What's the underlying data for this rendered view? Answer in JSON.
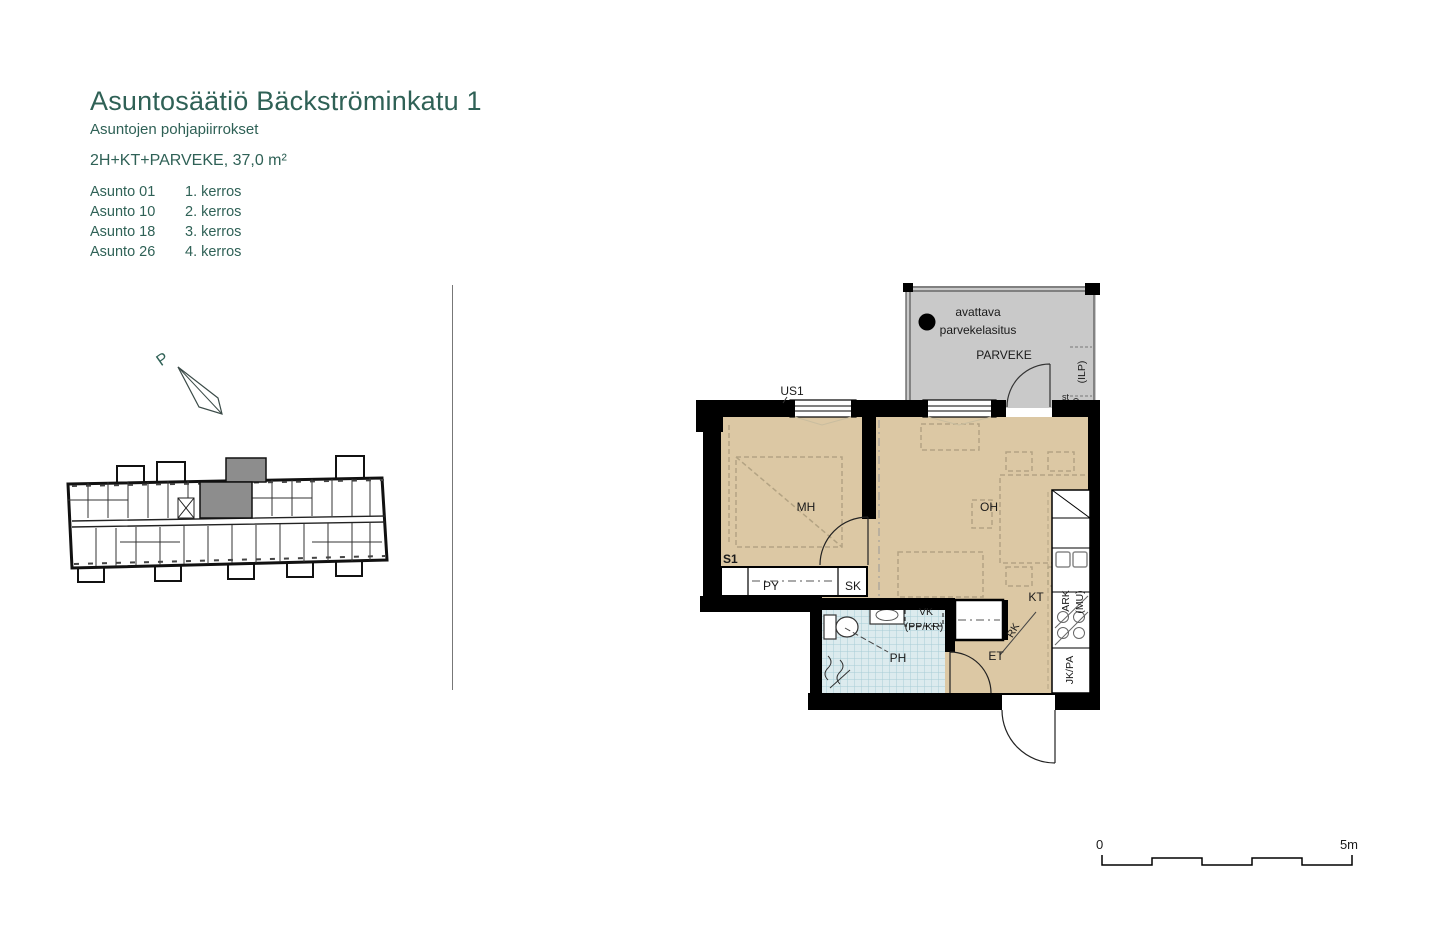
{
  "header": {
    "title": "Asuntosäätiö Bäckströminkatu 1",
    "subtitle": "Asuntojen pohjapiirrokset",
    "type_area": "2H+KT+PARVEKE, 37,0 m²",
    "units": [
      {
        "name": "Asunto 01",
        "floor": "1. kerros"
      },
      {
        "name": "Asunto 10",
        "floor": "2. kerros"
      },
      {
        "name": "Asunto 18",
        "floor": "3. kerros"
      },
      {
        "name": "Asunto 26",
        "floor": "4. kerros"
      }
    ]
  },
  "north": {
    "label": "P"
  },
  "plan": {
    "labels": {
      "glazing_note_line1": "avattava",
      "glazing_note_line2": "parvekelasitus",
      "parveke": "PARVEKE",
      "ilp": "(ILP)",
      "st": "st",
      "us1": "US1",
      "s1": "S1",
      "mh": "MH",
      "oh": "OH",
      "py": "PY",
      "sk": "SK",
      "kt": "KT",
      "ph": "PH",
      "et": "ET",
      "vk_line1": "VK",
      "vk_line2": "(PP/KR)",
      "rk": "RK",
      "ark_line1": "ARK",
      "ark_line2": "(MU)",
      "jk_pa": "JK/PA"
    },
    "colors": {
      "accent": "#2f6156",
      "floor": "#dcc8a4",
      "balcony": "#c9c9c9",
      "tile": "#dcebee",
      "tilegrid": "#a8cdd6",
      "wall": "#000000",
      "highlight": "#8d8d8d",
      "furniture": "#b3a383"
    }
  },
  "scalebar": {
    "zero": "0",
    "five": "5m"
  }
}
